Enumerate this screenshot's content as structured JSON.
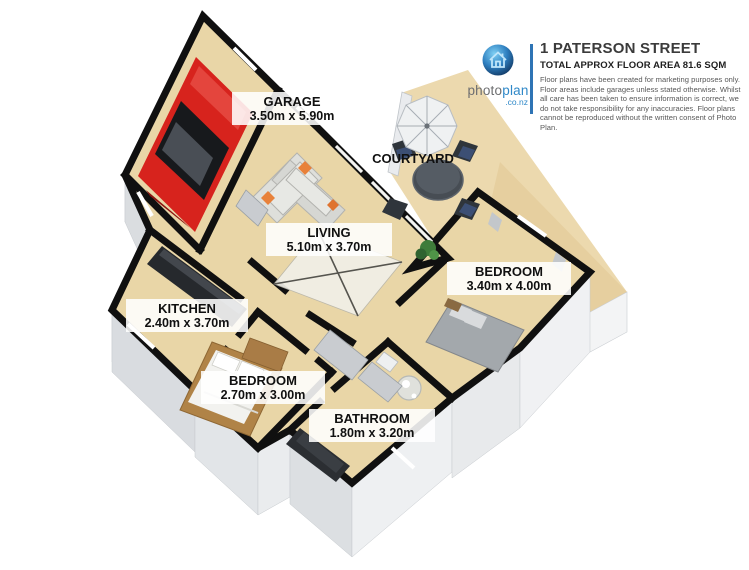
{
  "header": {
    "title": "1 PATERSON STREET",
    "subtitle": "TOTAL APPROX FLOOR AREA 81.6 SQM",
    "disclaimer": "Floor plans have been created for marketing purposes only. Floor areas include garages unless stated otherwise. Whilst all care has been taken to ensure information is correct, we do not take responsibility for any inaccuracies. Floor plans cannot be reproduced without the written consent of Photo Plan.",
    "logo": {
      "word_gray": "photo",
      "word_blue": "plan",
      "domain": ".co.nz"
    }
  },
  "floor_area_sqm": "81.6",
  "rooms": {
    "garage": {
      "name": "GARAGE",
      "dims": "3.50m x 5.90m"
    },
    "courtyard": {
      "name": "COURTYARD",
      "dims": ""
    },
    "living": {
      "name": "LIVING",
      "dims": "5.10m x 3.70m"
    },
    "kitchen": {
      "name": "KITCHEN",
      "dims": "2.40m x 3.70m"
    },
    "bedroom_main": {
      "name": "BEDROOM",
      "dims": "3.40m x 4.00m"
    },
    "bedroom_second": {
      "name": "BEDROOM",
      "dims": "2.70m x 3.00m"
    },
    "bathroom": {
      "name": "BATHROOM",
      "dims": "1.80m x 3.20m"
    }
  },
  "colors": {
    "floor": "#e9d6a7",
    "outdoor": "#ecd9ae",
    "wall": "#101010",
    "wall_face": "#e3e6e9",
    "accent_blue": "#2e74b5",
    "car_red": "#d7231d"
  }
}
